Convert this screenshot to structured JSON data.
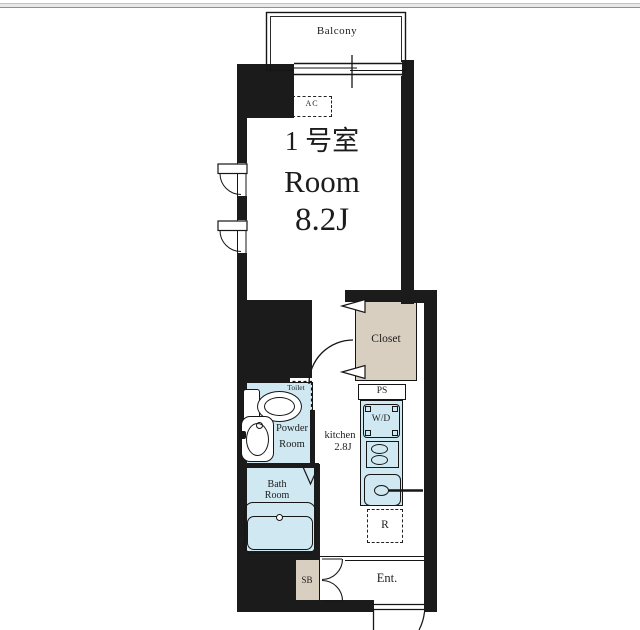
{
  "floorplan": {
    "balcony_label": "Balcony",
    "ac_label": "AC",
    "unit_title": {
      "line1": "1 号室",
      "line2": "Room",
      "line3": "8.2J"
    },
    "closet_label": "Closet",
    "ps_label": "PS",
    "toilet_label": "Toilet",
    "powder_room": {
      "line1": "Powder",
      "line2": "Room"
    },
    "bath_room": {
      "line1": "Bath",
      "line2": "Room"
    },
    "kitchen": {
      "line1": "kitchen",
      "line2": "2.8J"
    },
    "washer_dryer_label": "W/D",
    "refrigerator_label": "R",
    "shoe_box_label": "SB",
    "entrance_label": "Ent.",
    "colors": {
      "wall": "#1b1b1b",
      "wet_area_fill": "#cfe8f2",
      "storage_fill": "#d9cfc0"
    }
  }
}
